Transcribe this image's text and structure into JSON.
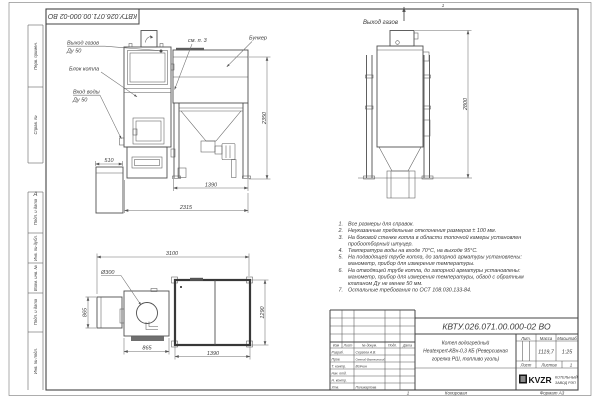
{
  "doc": {
    "designation": "КВТУ.026.071.00.000-02 ВО",
    "zone_top": "1",
    "zone_bottom": "1",
    "zone_left": "А",
    "copied": "Копировал",
    "format": "Формат А3"
  },
  "frame_labels": [
    "Перв. примен.",
    "Справ. №",
    "Подп. и дата",
    "Инв. № дубл.",
    "Взам. инв. №",
    "Подп. и дата",
    "Инв. № подл."
  ],
  "views": {
    "front": {
      "gas_out1": "Выход газов",
      "gas_out2": "Ду 50",
      "boiler": "Блок котла",
      "water1": "Вход воды",
      "water2": "Ду 50",
      "see_note": "см. п. 3",
      "hopper": "Бункер",
      "dims": {
        "w_ash": "510",
        "w_hopper": "1390",
        "w_total": "2315",
        "h_hopper": "2350"
      }
    },
    "side": {
      "gas_out": "Выход газов",
      "dims": {
        "h_total": "2800"
      }
    },
    "plan": {
      "hole": "Ø300",
      "dims": {
        "w_total": "3100",
        "h_ash": "865",
        "w_boiler": "865",
        "w_hopper": "1390",
        "h_hopper": "1290"
      }
    }
  },
  "notes": {
    "lines": [
      {
        "n": "1.",
        "t": "Все размеры для справок."
      },
      {
        "n": "2.",
        "t": "Неуказанные предельные отклонения размеров ± 100 мм."
      },
      {
        "n": "3.",
        "t": "На боковой стенке котла в области топочной камеры установлен"
      },
      {
        "n": "",
        "t": "пробоотборный штуцер."
      },
      {
        "n": "4.",
        "t": "Температура воды на входе 70°С, на выходе 95°С."
      },
      {
        "n": "5.",
        "t": "На подводящей трубе котла, до запорной арматуры установлены:"
      },
      {
        "n": "",
        "t": "манометр, прибор для измерения температуры."
      },
      {
        "n": "6.",
        "t": "На отводящей трубе котла, до запорной арматуры установлены:"
      },
      {
        "n": "",
        "t": "манометр, прибор для измерения температуры, обвод с обратным"
      },
      {
        "n": "",
        "t": "клапаном Ду не менее 50 мм."
      },
      {
        "n": "7.",
        "t": "Остальные требования по ОСТ 108.030.133-84."
      }
    ]
  },
  "tb": {
    "designation": "КВТУ.026.071.00.000-02 ВО",
    "name1": "Котел водогрейный",
    "name2": "Heatexpert-КВн-0,3 КБ (Реверсивная",
    "name3": "горелка РШ, топливо уголь)",
    "cols": {
      "izm": "Изм",
      "list": "Лист",
      "doc": "№ докум.",
      "podp": "Подп.",
      "data": "Дата"
    },
    "rows": [
      {
        "r": "Разраб.",
        "n": "Сергеев А.В."
      },
      {
        "r": "Пров.",
        "n": "Омелой-Вережинский"
      },
      {
        "r": "Т. контр.",
        "n": "Всячин"
      },
      {
        "r": "Нач. отд.",
        "n": ""
      },
      {
        "r": "Н. контр.",
        "n": ""
      },
      {
        "r": "Утв.",
        "n": "Поликарпова"
      }
    ],
    "lit": "Лит.",
    "mass": "Масса",
    "scale": "Масштаб",
    "mass_v": "1119,7",
    "scale_v": "1:25",
    "sheet": "Лист",
    "sheets": "Листов",
    "sheets_v": "1",
    "logo": "KVZR",
    "org1": "КОТЕЛЬНЫЙ",
    "org2": "ЗАВОД РЭП"
  }
}
